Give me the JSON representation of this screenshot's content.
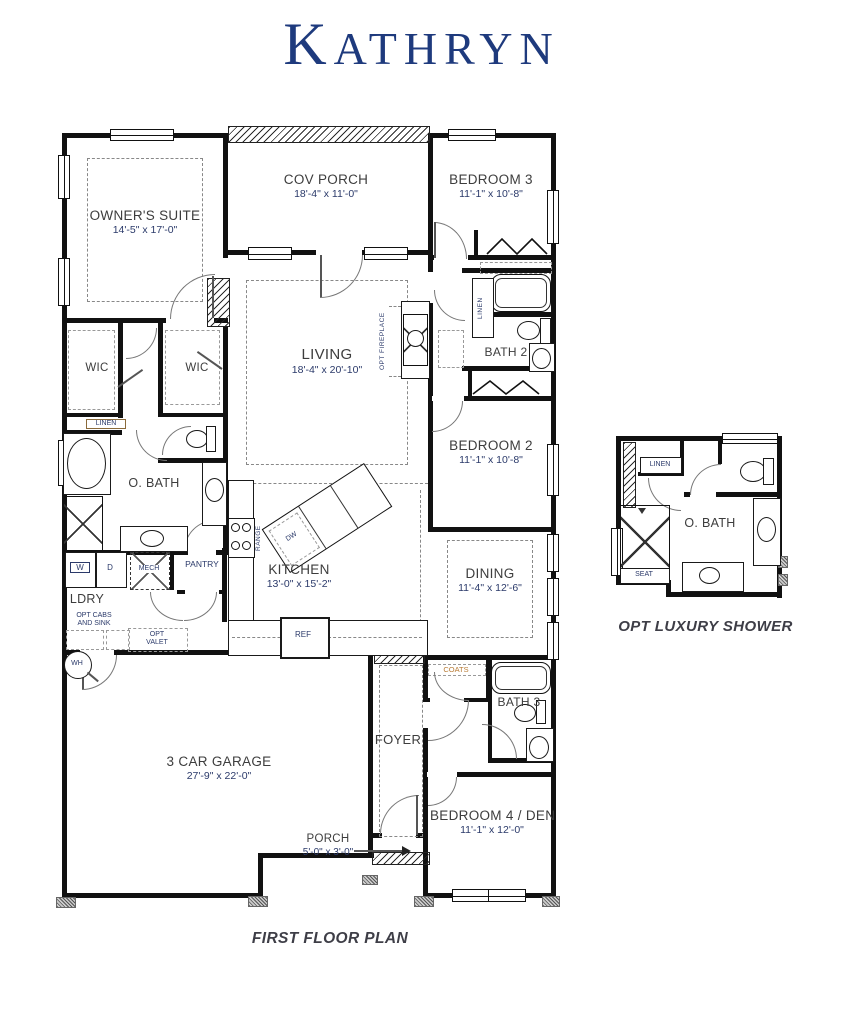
{
  "title": "Kathryn",
  "plan_caption": "FIRST FLOOR PLAN",
  "inset": {
    "caption": "OPT LUXURY SHOWER",
    "room_label": "O. BATH",
    "linen": "LINEN",
    "seat": "SEAT"
  },
  "rooms": {
    "owners_suite": {
      "label": "OWNER'S SUITE",
      "dims": "14'-5\" x 17'-0\""
    },
    "cov_porch": {
      "label": "COV PORCH",
      "dims": "18'-4\" x 11'-0\""
    },
    "bedroom3": {
      "label": "BEDROOM 3",
      "dims": "11'-1\" x 10'-8\""
    },
    "living": {
      "label": "LIVING",
      "dims": "18'-4\" x 20'-10\""
    },
    "bath2": {
      "label": "BATH 2"
    },
    "bedroom2": {
      "label": "BEDROOM 2",
      "dims": "11'-1\" x 10'-8\""
    },
    "wic_left": {
      "label": "WIC"
    },
    "wic_right": {
      "label": "WIC"
    },
    "owners_bath": {
      "label": "O. BATH"
    },
    "kitchen": {
      "label": "KITCHEN",
      "dims": "13'-0\" x 15'-2\""
    },
    "dining": {
      "label": "DINING",
      "dims": "11'-4\" x 12'-6\""
    },
    "laundry": {
      "label": "LDRY"
    },
    "pantry": {
      "label": "PANTRY"
    },
    "garage": {
      "label": "3 CAR GARAGE",
      "dims": "27'-9\" x 22'-0\""
    },
    "foyer": {
      "label": "FOYER"
    },
    "bath3": {
      "label": "BATH 3"
    },
    "bedroom4": {
      "label": "BEDROOM 4 / DEN",
      "dims": "11'-1\" x 12'-0\""
    },
    "porch": {
      "label": "PORCH",
      "dims": "5'-0\" x 3'-0\""
    }
  },
  "fixtures": {
    "linen1": "LINEN",
    "linen2": "LINEN",
    "mech": "MECH",
    "washer": "W",
    "dryer": "D",
    "opt_cabs_line1": "OPT CABS",
    "opt_cabs_line2": "AND SINK",
    "opt_valet_line1": "OPT",
    "opt_valet_line2": "VALET",
    "water_heater": "WH",
    "range": "RANGE",
    "dishwasher": "DW",
    "refrigerator": "REF",
    "coats": "COATS",
    "opt_fireplace": "OPT FIREPLACE"
  },
  "colors": {
    "title": "#1e3a7d",
    "room_label": "#3d3d3d",
    "dimension": "#2b3a6a",
    "accent": "#b87a33",
    "wall": "#111111"
  }
}
